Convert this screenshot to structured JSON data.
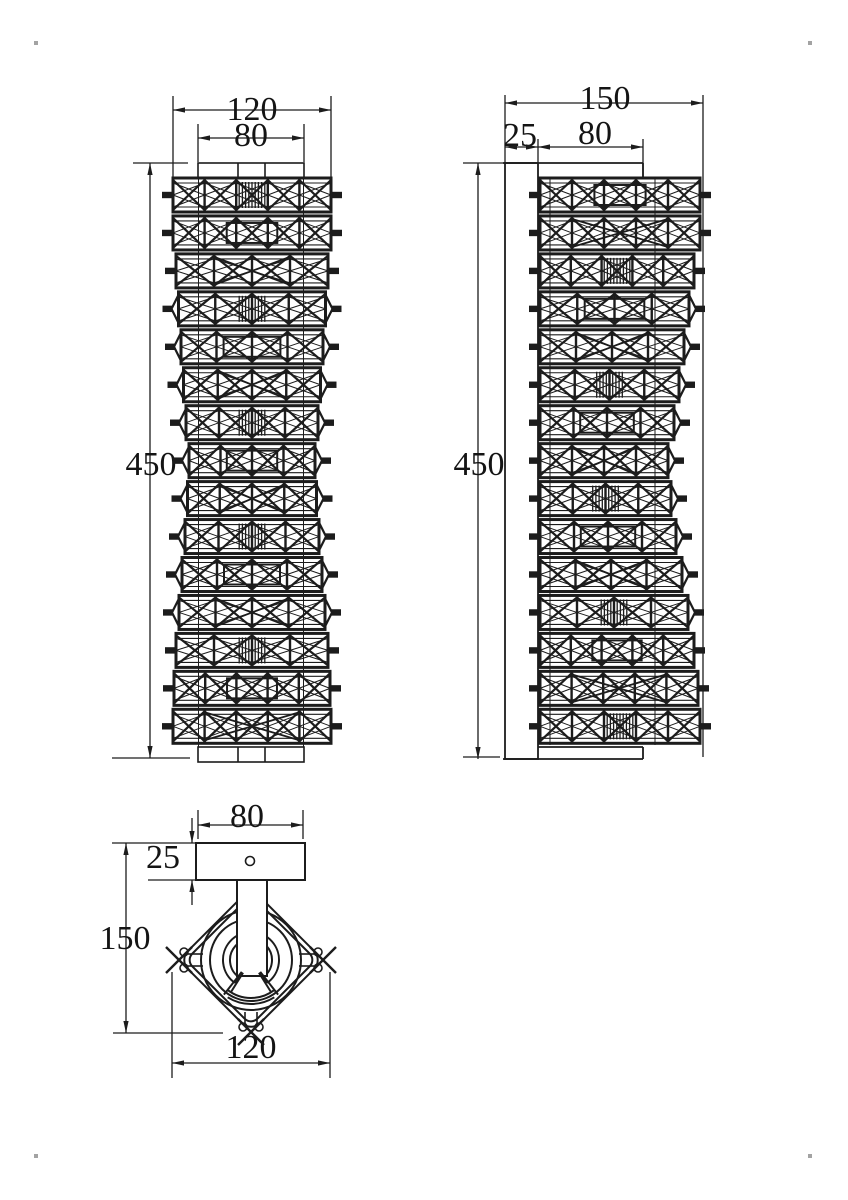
{
  "sheet": {
    "background": "#ffffff",
    "line_color": "#1c1c1c",
    "kind": "wall-lamp orthographic technical drawing"
  },
  "front_view": {
    "dim_width": "120",
    "dim_inner_width": "80",
    "dim_height": "450",
    "segment_count": 15
  },
  "side_view": {
    "dim_depth": "150",
    "dim_plate": "25",
    "dim_inner": "80",
    "dim_height": "450",
    "segment_count": 15
  },
  "top_view": {
    "dim_plate_width": "80",
    "dim_plate_depth": "25",
    "dim_body_depth": "150",
    "dim_body_width": "120"
  }
}
